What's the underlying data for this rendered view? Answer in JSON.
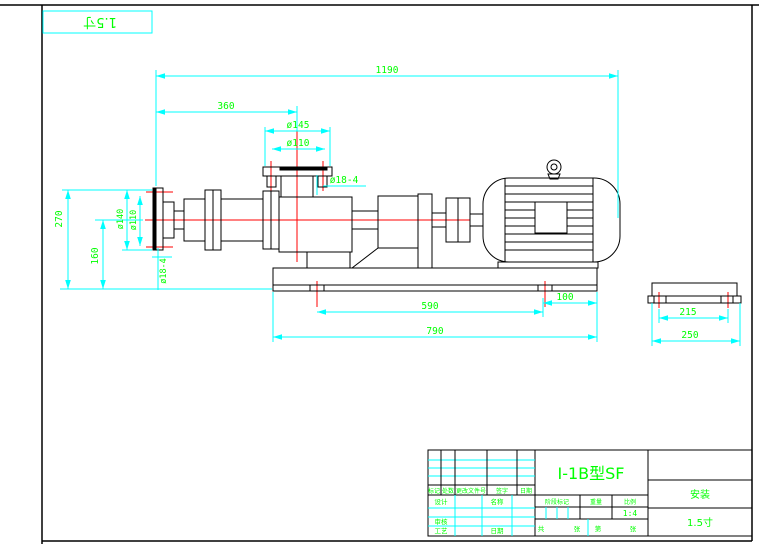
{
  "colors": {
    "outline": "#000000",
    "dimension_line": "#00ffff",
    "dimension_text": "#00ff00",
    "centerline": "#ff0000",
    "background": "#ffffff"
  },
  "corner": {
    "label": "1.5寸"
  },
  "dims": {
    "total_length": "1190",
    "inlet_to_outlet": "360",
    "outlet_flange_od": "ø145",
    "outlet_bolt_circle": "ø110",
    "outlet_bolt_holes": "ø18-4",
    "overall_height": "270",
    "axis_height": "160",
    "inlet_flange_od": "ø140",
    "inlet_bolt_circle": "ø110",
    "inlet_bolt_holes": "ø18-4",
    "anchor_bolt_span": "590",
    "base_overhang": "100",
    "base_length": "790",
    "anchor_bolt_width": "215",
    "base_width": "250"
  },
  "title_block": {
    "drawing_name": "I-1B型SF",
    "sheet_title": "安装",
    "size_label": "1.5寸",
    "scale_value": "1:4",
    "rev_headers": [
      "标记",
      "处数",
      "更改文件号",
      "签字",
      "日期"
    ],
    "labels": {
      "design": "设计",
      "check": "审核",
      "process": "工艺",
      "name": "名称",
      "date": "日期",
      "stage": "阶段标记",
      "weight": "重量",
      "scale": "比例",
      "total": "共",
      "sheets": "张",
      "page": "第",
      "pages": "张"
    }
  }
}
